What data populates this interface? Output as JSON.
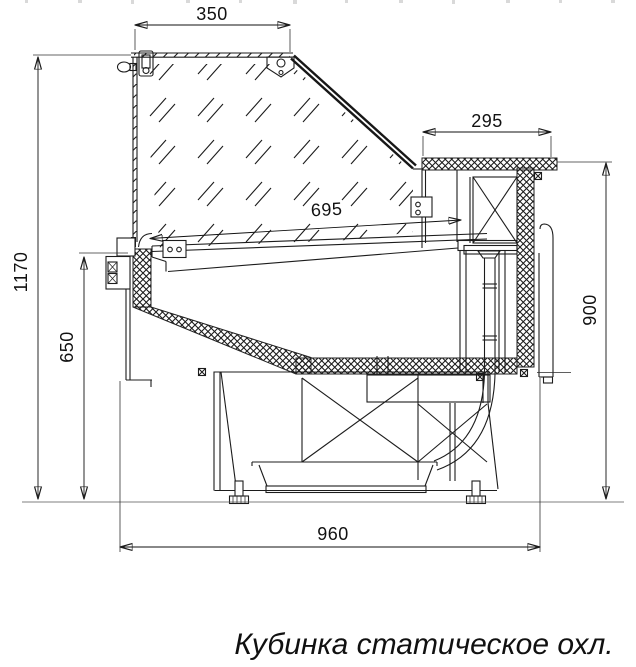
{
  "drawing": {
    "caption": "Кубинка статическое охл.",
    "dims": {
      "lid_width": "350",
      "rear_top_depth": "295",
      "deck_depth": "695",
      "total_height": "1170",
      "front_height": "650",
      "rear_height": "900",
      "total_depth": "960"
    },
    "colors": {
      "line": "#1c1c1c",
      "dimension": "#111111",
      "background": "#ffffff",
      "glass_hatch": "#8f8f8f",
      "insulation_hatch": "#565656",
      "floor_line": "#555555"
    }
  }
}
